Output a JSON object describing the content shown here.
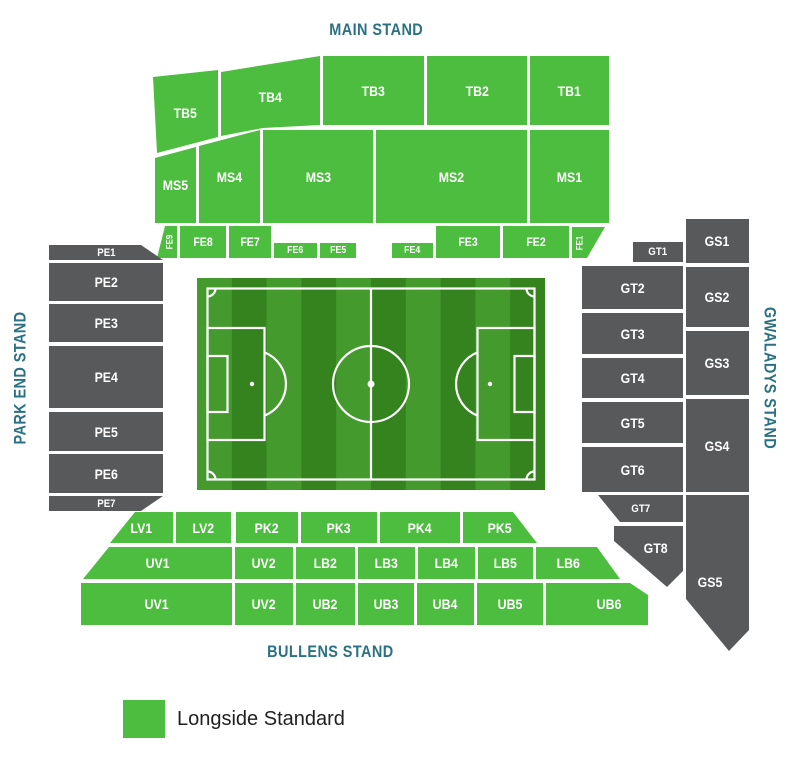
{
  "stand_titles": {
    "main": "MAIN STAND",
    "park_end": "PARK END STAND",
    "gwaladys": "GWALADYS STAND",
    "bullens": "BULLENS STAND"
  },
  "sections": {
    "TB1": "TB1",
    "TB2": "TB2",
    "TB3": "TB3",
    "TB4": "TB4",
    "TB5": "TB5",
    "MS1": "MS1",
    "MS2": "MS2",
    "MS3": "MS3",
    "MS4": "MS4",
    "MS5": "MS5",
    "FE1": "FE1",
    "FE2": "FE2",
    "FE3": "FE3",
    "FE4": "FE4",
    "FE5": "FE5",
    "FE6": "FE6",
    "FE7": "FE7",
    "FE8": "FE8",
    "FE9": "FE9",
    "PE1": "PE1",
    "PE2": "PE2",
    "PE3": "PE3",
    "PE4": "PE4",
    "PE5": "PE5",
    "PE6": "PE6",
    "PE7": "PE7",
    "GT1": "GT1",
    "GT2": "GT2",
    "GT3": "GT3",
    "GT4": "GT4",
    "GT5": "GT5",
    "GT6": "GT6",
    "GT7": "GT7",
    "GT8": "GT8",
    "GS1": "GS1",
    "GS2": "GS2",
    "GS3": "GS3",
    "GS4": "GS4",
    "GS5": "GS5",
    "LV1": "LV1",
    "LV2": "LV2",
    "PK2": "PK2",
    "PK3": "PK3",
    "PK4": "PK4",
    "PK5": "PK5",
    "UV1": "UV1",
    "UV2": "UV2",
    "LB2": "LB2",
    "LB3": "LB3",
    "LB4": "LB4",
    "LB5": "LB5",
    "LB6": "LB6",
    "UB2": "UB2",
    "UB3": "UB3",
    "UB4": "UB4",
    "UB5": "UB5",
    "UB6": "UB6"
  },
  "legend": {
    "items": [
      {
        "label": "Longside Standard",
        "color": "#4cbd3e"
      }
    ]
  },
  "colors": {
    "longside_green": "#4cbd3e",
    "other_stand_gray": "#58595b",
    "title_teal": "#2a7183",
    "pitch_stripe_dark": "#35831f",
    "pitch_stripe_light": "#459a2e",
    "pitch_line": "#ffffff",
    "section_text": "#ffffff",
    "legend_text": "#1f1f1f"
  }
}
